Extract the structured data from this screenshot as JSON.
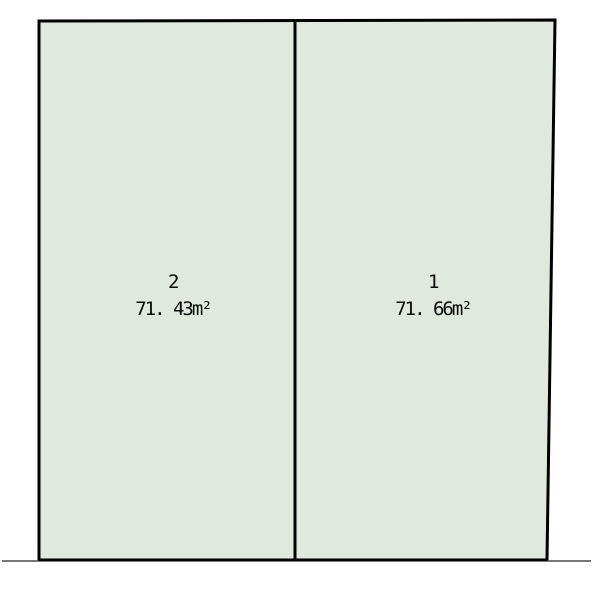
{
  "diagram": {
    "type": "land-parcel-subdivision-plan",
    "parcels": [
      {
        "number": "2",
        "area": "71. 43m²",
        "position": "left"
      },
      {
        "number": "1",
        "area": "71. 66m²",
        "position": "right"
      }
    ]
  },
  "colors": {
    "parcel_fill": "#dfeadd",
    "boundary": "#000000",
    "extension_line": "#4a4a4a"
  }
}
